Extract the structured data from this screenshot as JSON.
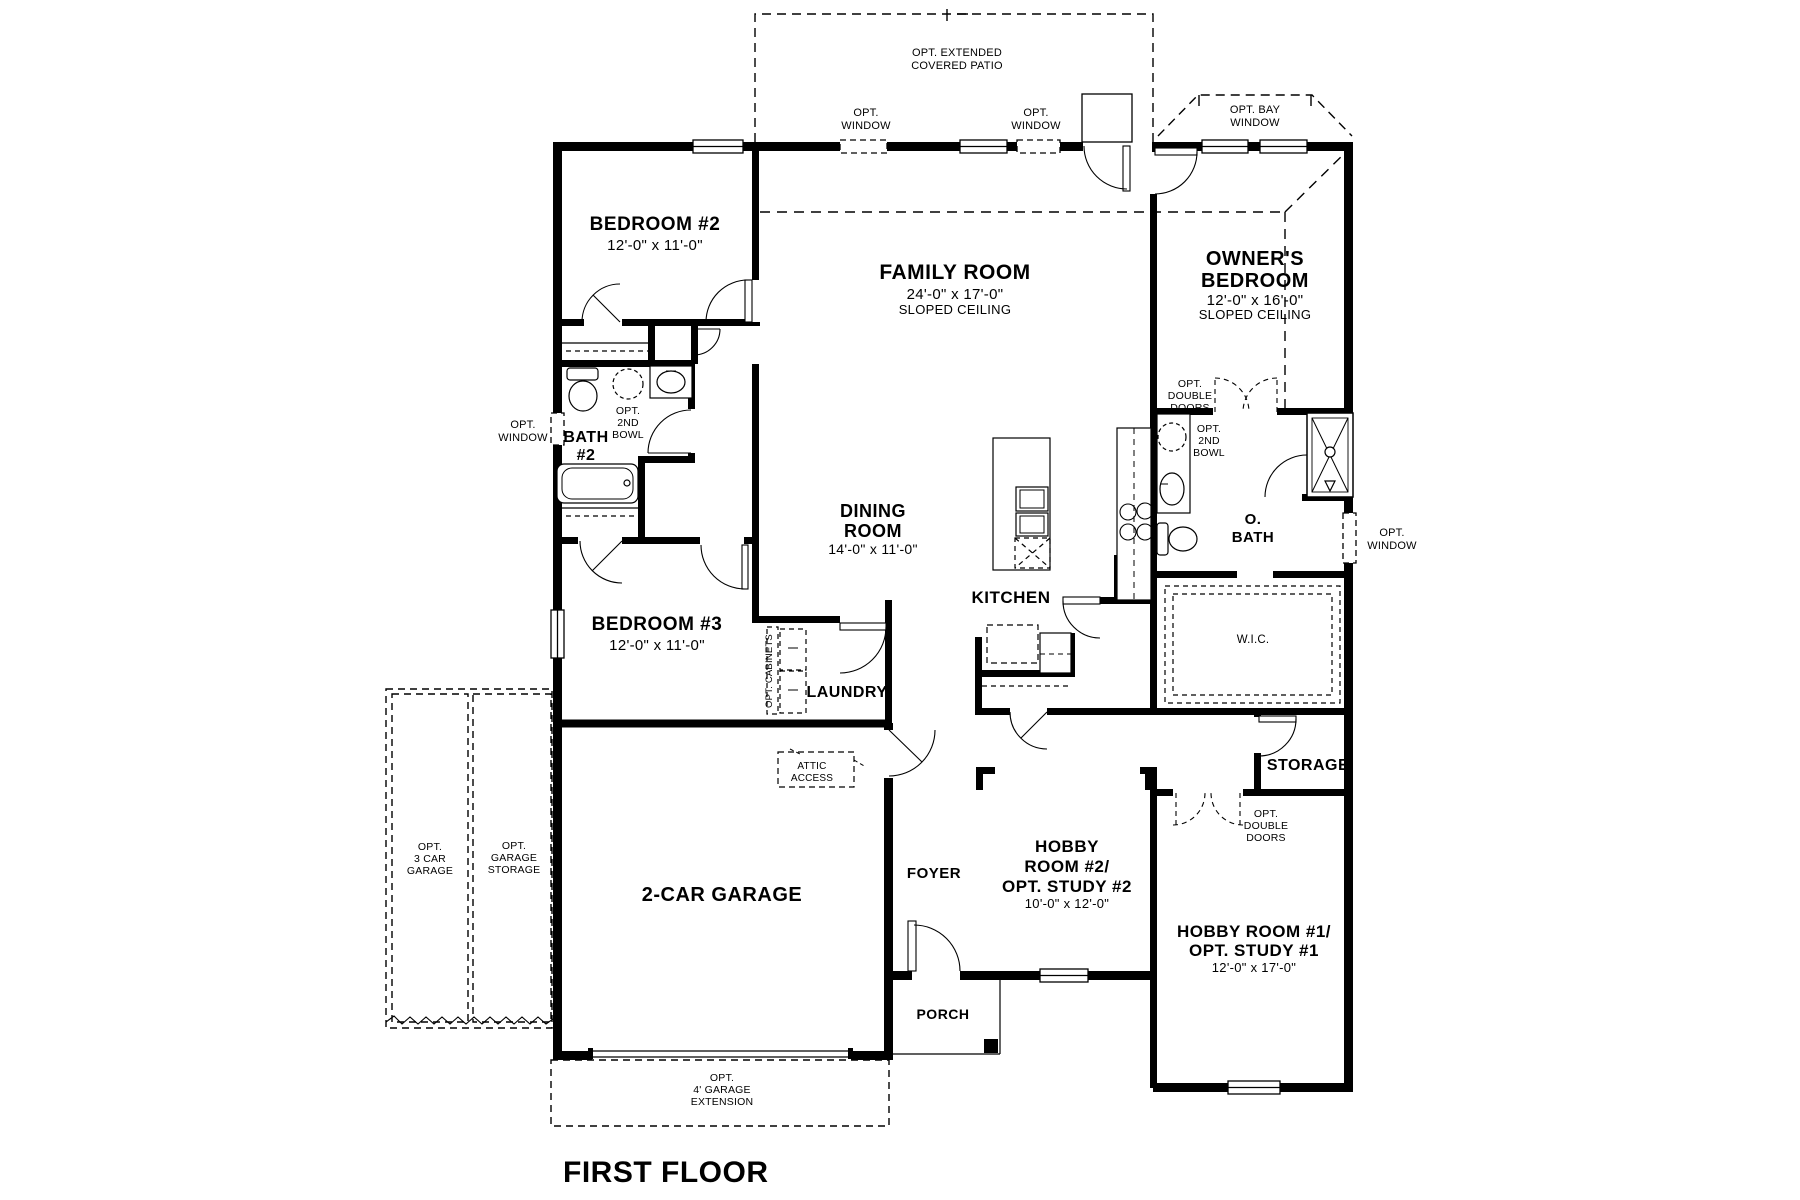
{
  "plan_title": "FIRST FLOOR",
  "rooms": {
    "bedroom2": {
      "name": "BEDROOM #2",
      "dims": "12'-0\" x 11'-0\""
    },
    "family_room": {
      "name": "FAMILY ROOM",
      "dims": "24'-0\" x 17'-0\"",
      "note": "SLOPED CEILING"
    },
    "owners_bedroom": {
      "name_line1": "OWNER'S",
      "name_line2": "BEDROOM",
      "dims": "12'-0\" x 16'-0\"",
      "note": "SLOPED CEILING"
    },
    "bath2": {
      "name_line1": "BATH",
      "name_line2": "#2"
    },
    "dining_room": {
      "name_line1": "DINING",
      "name_line2": "ROOM",
      "dims": "14'-0\" x 11'-0\""
    },
    "kitchen": {
      "name": "KITCHEN"
    },
    "owners_bath": {
      "name_line1": "O.",
      "name_line2": "BATH"
    },
    "wic": {
      "name": "W.I.C."
    },
    "bedroom3": {
      "name": "BEDROOM #3",
      "dims": "12'-0\" x 11'-0\""
    },
    "laundry": {
      "name": "LAUNDRY"
    },
    "storage": {
      "name": "STORAGE"
    },
    "garage": {
      "name": "2-CAR GARAGE"
    },
    "foyer": {
      "name": "FOYER"
    },
    "hobby_room2": {
      "name_line1": "HOBBY",
      "name_line2": "ROOM #2/",
      "name_line3": "OPT. STUDY #2",
      "dims": "10'-0\" x 12'-0\""
    },
    "hobby_room1": {
      "name_line1": "HOBBY ROOM #1/",
      "name_line2": "OPT. STUDY #1",
      "dims": "12'-0\" x 17'-0\""
    },
    "porch": {
      "name": "PORCH"
    }
  },
  "annotations": {
    "covered_patio": [
      "OPT. EXTENDED",
      "COVERED PATIO"
    ],
    "opt_window": [
      "OPT.",
      "WINDOW"
    ],
    "opt_bay_window": [
      "OPT. BAY",
      "WINDOW"
    ],
    "opt_double_doors": [
      "OPT.",
      "DOUBLE",
      "DOORS"
    ],
    "opt_2nd_bowl": [
      "OPT.",
      "2ND",
      "BOWL"
    ],
    "opt_cabinets": "OPT. CABINETS",
    "attic_access": [
      "ATTIC",
      "ACCESS"
    ],
    "opt_3car_garage": [
      "OPT.",
      "3 CAR",
      "GARAGE"
    ],
    "opt_garage_storage": [
      "OPT.",
      "GARAGE",
      "STORAGE"
    ],
    "opt_garage_extension": [
      "OPT.",
      "4' GARAGE",
      "EXTENSION"
    ]
  },
  "colors": {
    "wall": "#000000",
    "background": "#ffffff"
  }
}
